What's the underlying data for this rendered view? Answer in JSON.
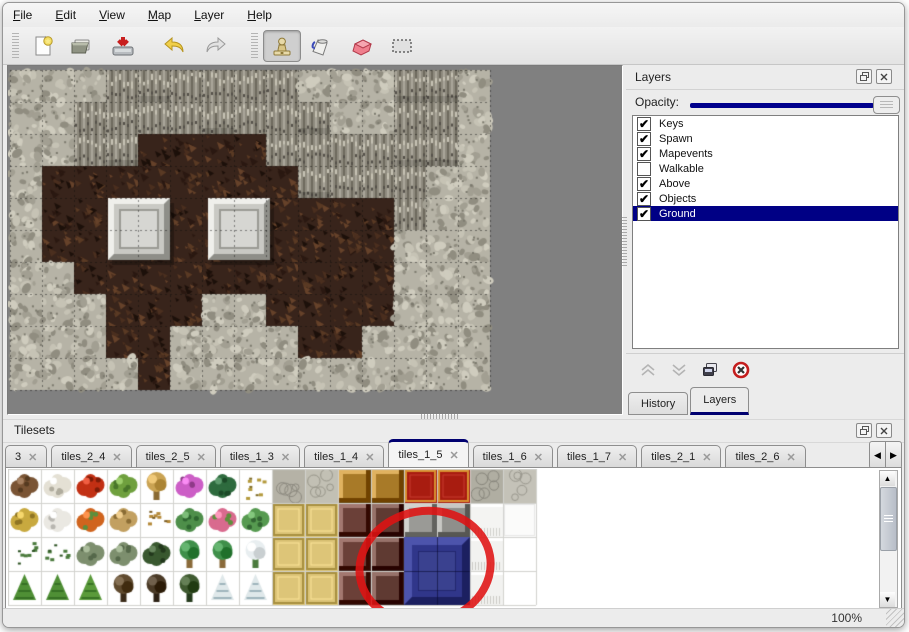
{
  "menu": {
    "items": [
      {
        "label": "File"
      },
      {
        "label": "Edit"
      },
      {
        "label": "View"
      },
      {
        "label": "Map"
      },
      {
        "label": "Layer"
      },
      {
        "label": "Help"
      }
    ]
  },
  "toolbar": {
    "buttons": [
      "new-file",
      "open-file",
      "save-file",
      "undo",
      "redo",
      "stamp-tool",
      "fill-tool",
      "eraser-tool",
      "rect-select-tool"
    ],
    "active_tool": "stamp-tool"
  },
  "map_panel": {
    "tile_size": 32,
    "grid": [
      "fffccccccfffccf",
      "ffccccccccffccf",
      "ffccbbbbccccccf",
      "fbbbbbbbbccccff",
      "fbbbbbbbbbbbcff",
      "fbbbbbbbbbbbfff",
      "ffbbbbbbbbbbfff",
      "fffbbbffbbbbfff",
      "fffbbffffbbffff",
      "ffffbffffffffff"
    ],
    "colors": {
      "floor": "#b6b3a6",
      "cliff": "#8f8b7e",
      "ground": "#38241b",
      "backdrop": "#808080"
    },
    "pillars": [
      {
        "x": 98,
        "y": 128,
        "w": 62,
        "h": 62
      },
      {
        "x": 198,
        "y": 128,
        "w": 62,
        "h": 62
      }
    ]
  },
  "layers_panel": {
    "title": "Layers",
    "opacity_label": "Opacity:",
    "opacity_fraction": 1.0,
    "layers": [
      {
        "name": "Keys",
        "checked": true,
        "selected": false
      },
      {
        "name": "Spawn",
        "checked": true,
        "selected": false
      },
      {
        "name": "Mapevents",
        "checked": true,
        "selected": false
      },
      {
        "name": "Walkable",
        "checked": false,
        "selected": false
      },
      {
        "name": "Above",
        "checked": true,
        "selected": false
      },
      {
        "name": "Objects",
        "checked": true,
        "selected": false
      },
      {
        "name": "Ground",
        "checked": true,
        "selected": true
      }
    ],
    "buttons": [
      "move-layer-up",
      "move-layer-down",
      "duplicate-layer",
      "delete-layer"
    ],
    "bottom_tabs": [
      {
        "label": "History",
        "active": false
      },
      {
        "label": "Layers",
        "active": true
      }
    ]
  },
  "tilesets_panel": {
    "title": "Tilesets",
    "tabs": [
      {
        "label": "3",
        "active": false
      },
      {
        "label": "tiles_2_4",
        "active": false
      },
      {
        "label": "tiles_2_5",
        "active": false
      },
      {
        "label": "tiles_1_3",
        "active": false
      },
      {
        "label": "tiles_1_4",
        "active": false
      },
      {
        "label": "tiles_1_5",
        "active": true
      },
      {
        "label": "tiles_1_6",
        "active": false
      },
      {
        "label": "tiles_1_7",
        "active": false
      },
      {
        "label": "tiles_2_1",
        "active": false
      },
      {
        "label": "tiles_2_6",
        "active": false
      }
    ],
    "tile_w": 33,
    "tile_h": 34,
    "tiles": [
      [
        [
          "blob",
          "#7a5434",
          "#553a20"
        ],
        [
          "blob",
          "#e4e0d4",
          "#b0ac9e"
        ],
        [
          "blob",
          "#c23014",
          "#7e1c08"
        ],
        [
          "blob",
          "#6fa03e",
          "#49762a"
        ],
        [
          "tree",
          "#caa353",
          "#8a6a33"
        ],
        [
          "blob",
          "#cc5ec6",
          "#8e3a88"
        ],
        [
          "blob",
          "#2e6b3e",
          "#1c4a28"
        ],
        [
          "bits",
          "#b49a3c",
          "#7e6a24"
        ],
        [
          "stone",
          "#b5b2a6",
          "#8d8a80"
        ],
        [
          "stone",
          "#c2c0b4",
          "#98968a"
        ],
        [
          "block",
          "#a87a28",
          "#6b4a14"
        ],
        [
          "block",
          "#a87a28",
          "#6b4a14"
        ],
        [
          "mat",
          "#a81c10",
          "#d89030"
        ],
        [
          "mat",
          "#a81c10",
          "#d89030"
        ],
        [
          "stone",
          "#b0aea2",
          "#88867c"
        ],
        [
          "stone",
          "#c4c2b8",
          "#9a988e"
        ]
      ],
      [
        [
          "blob",
          "#c8a93f",
          "#8f7524"
        ],
        [
          "blob",
          "#eae8e2",
          "#b8b6b0"
        ],
        [
          "blob",
          "#d0641e",
          "#5d8f3c"
        ],
        [
          "blob",
          "#c2a060",
          "#8a6c34"
        ],
        [
          "bits",
          "#b58a3a",
          "#7a5c22"
        ],
        [
          "blob",
          "#4e8f4a",
          "#2e6630"
        ],
        [
          "blob",
          "#d96a8e",
          "#5d8f3c"
        ],
        [
          "blob",
          "#569a50",
          "#336633"
        ],
        [
          "mat",
          "#ddc578",
          "#a89040"
        ],
        [
          "mat",
          "#ddc578",
          "#a89040"
        ],
        [
          "block",
          "#6b4038",
          "#3f2420"
        ],
        [
          "block",
          "#5f3a32",
          "#38201c"
        ],
        [
          "block",
          "#9a9a96",
          "#5f5f5c"
        ],
        [
          "block",
          "#8f8f8b",
          "#55554f"
        ],
        [
          "cloth",
          "#f4f4f2",
          "#d0d0cc"
        ],
        [
          "flat",
          "#fbfbfa",
          "#e8e8e6"
        ]
      ],
      [
        [
          "bits",
          "#4a7a3c",
          "#2e5424"
        ],
        [
          "bits",
          "#4a7a3c",
          "#2e5424"
        ],
        [
          "blob",
          "#7d8f6e",
          "#55684a"
        ],
        [
          "blob",
          "#7d8f6e",
          "#55684a"
        ],
        [
          "blob",
          "#39582f",
          "#22381c"
        ],
        [
          "tree",
          "#3f8f4a",
          "#8a6a3a"
        ],
        [
          "tree",
          "#3f8f4a",
          "#8a6a3a"
        ],
        [
          "tree",
          "#e8eef0",
          "#4a7a3c"
        ],
        [
          "mat",
          "#ddc578",
          "#a89040"
        ],
        [
          "mat",
          "#ddc578",
          "#a89040"
        ],
        [
          "block",
          "#6b4038",
          "#3f2420"
        ],
        [
          "block",
          "#5f3a32",
          "#38201c"
        ],
        [
          "flat",
          "#ffffff",
          "#f0f0f0"
        ],
        [
          "flat",
          "#ffffff",
          "#f0f0f0"
        ],
        [
          "cloth",
          "#f2f2f0",
          "#cccbc6"
        ],
        [
          "none"
        ]
      ],
      [
        [
          "cone",
          "#4f8f35",
          "#2f6620"
        ],
        [
          "cone",
          "#4f8f35",
          "#2f6620"
        ],
        [
          "cone",
          "#5a9a3a",
          "#2f6620"
        ],
        [
          "tree",
          "#5f4a2e",
          "#3a2a18"
        ],
        [
          "tree",
          "#4a3a26",
          "#2c2014"
        ],
        [
          "tree",
          "#3f5a30",
          "#243a1c"
        ],
        [
          "cone",
          "#dfe8ea",
          "#8aa4ac"
        ],
        [
          "cone",
          "#dfe8ea",
          "#8aa4ac"
        ],
        [
          "mat",
          "#ddc578",
          "#a89040"
        ],
        [
          "mat",
          "#ddc578",
          "#a89040"
        ],
        [
          "block",
          "#6b4038",
          "#3f2420"
        ],
        [
          "block",
          "#5f3a32",
          "#38201c"
        ],
        [
          "flat",
          "#ffffff",
          "#f0f0f0"
        ],
        [
          "flat",
          "#ffffff",
          "#f0f0f0"
        ],
        [
          "cloth",
          "#f2f2f0",
          "#cccbc6"
        ],
        [
          "none"
        ]
      ]
    ],
    "selected_blue_block": {
      "tile_x": 12,
      "tile_y": 2,
      "w_tiles": 2,
      "h_tiles": 2,
      "color": "#30368a"
    },
    "annotation": {
      "shape": "red-circle",
      "cx": 420,
      "cy": 99,
      "rx": 66,
      "ry": 56,
      "color": "#df1212",
      "stroke_width": 8,
      "rotation": -10
    }
  },
  "status_bar": {
    "zoom_level": "100%"
  }
}
